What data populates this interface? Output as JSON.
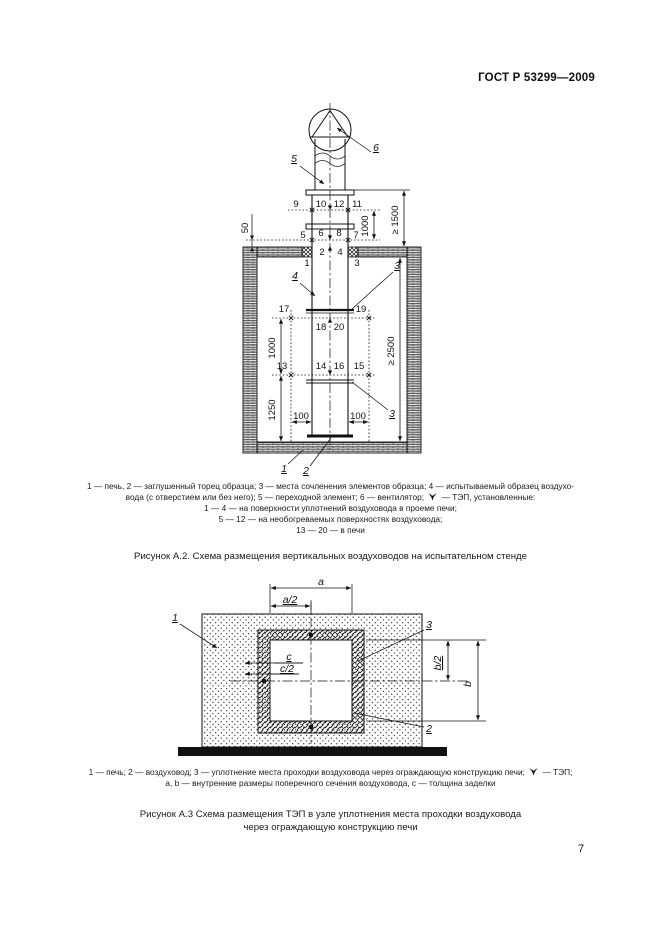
{
  "header": {
    "doc_code": "ГОСТ Р 53299—2009"
  },
  "page": {
    "number": "7"
  },
  "figure_a2": {
    "title": "Рисунок А.2. Схема размещения вертикальных воздуховодов на испытательном стенде",
    "legend": {
      "line1": "1 — печь, 2 — заглушенный торец образца; 3 — места сочленения элементов образца; 4 — испытываемый образец воздухо-",
      "line2_before_icon": "вода (с отверстием или без него); 5 — переходной элемент; 6 — вентилятор;",
      "line2_after_icon": "— ТЭП, установленные:",
      "line3": "1 — 4 — на поверхности уплотнений воздуховода в проеме печи;",
      "line4": "5 — 12 — на необогреваемых поверхностях воздуховода;",
      "line5": "13 — 20 — в печи"
    },
    "callouts": {
      "furnace": "1",
      "plug": "2",
      "joint_top": "3",
      "joint_bottom": "3",
      "specimen": "4",
      "transition": "5",
      "fan": "6"
    },
    "points": {
      "p1": "1",
      "p2": "2",
      "p3": "3",
      "p4": "4",
      "p5": "5",
      "p6": "6",
      "p7": "7",
      "p8": "8",
      "p9": "9",
      "p10": "10",
      "p11": "11",
      "p12": "12",
      "p13": "13",
      "p14": "14",
      "p15": "15",
      "p16": "16",
      "p17": "17",
      "p18": "18",
      "p19": "19",
      "p20": "20"
    },
    "dims": {
      "d50": "50",
      "d1000_upper": "1000",
      "d1500": "≥ 1500",
      "d1000_lower": "1000",
      "d1250": "1250",
      "d2500": "≥ 2500",
      "d100_left": "100",
      "d100_right": "100"
    }
  },
  "figure_a3": {
    "title_line1": "Рисунок А.3 Схема размещения ТЭП в узле уплотнения места проходки воздуховода",
    "title_line2": "через ограждающую конструкцию печи",
    "legend": {
      "line1_before_icon": "1 — печь; 2 — воздуховод; 3 — уплотнение места проходки воздуховода через ограждающую конструкцию печи;",
      "line1_after_icon": "— ТЭП;",
      "line2": "a, b — внутренние размеры поперечного сечения воздуховода, c — толщина заделки"
    },
    "callouts": {
      "furnace": "1",
      "duct": "2",
      "seal": "3"
    },
    "dims": {
      "a": "a",
      "a_half": "a/2",
      "b": "b",
      "b_half": "b/2",
      "c": "c",
      "c_half": "c/2"
    }
  }
}
